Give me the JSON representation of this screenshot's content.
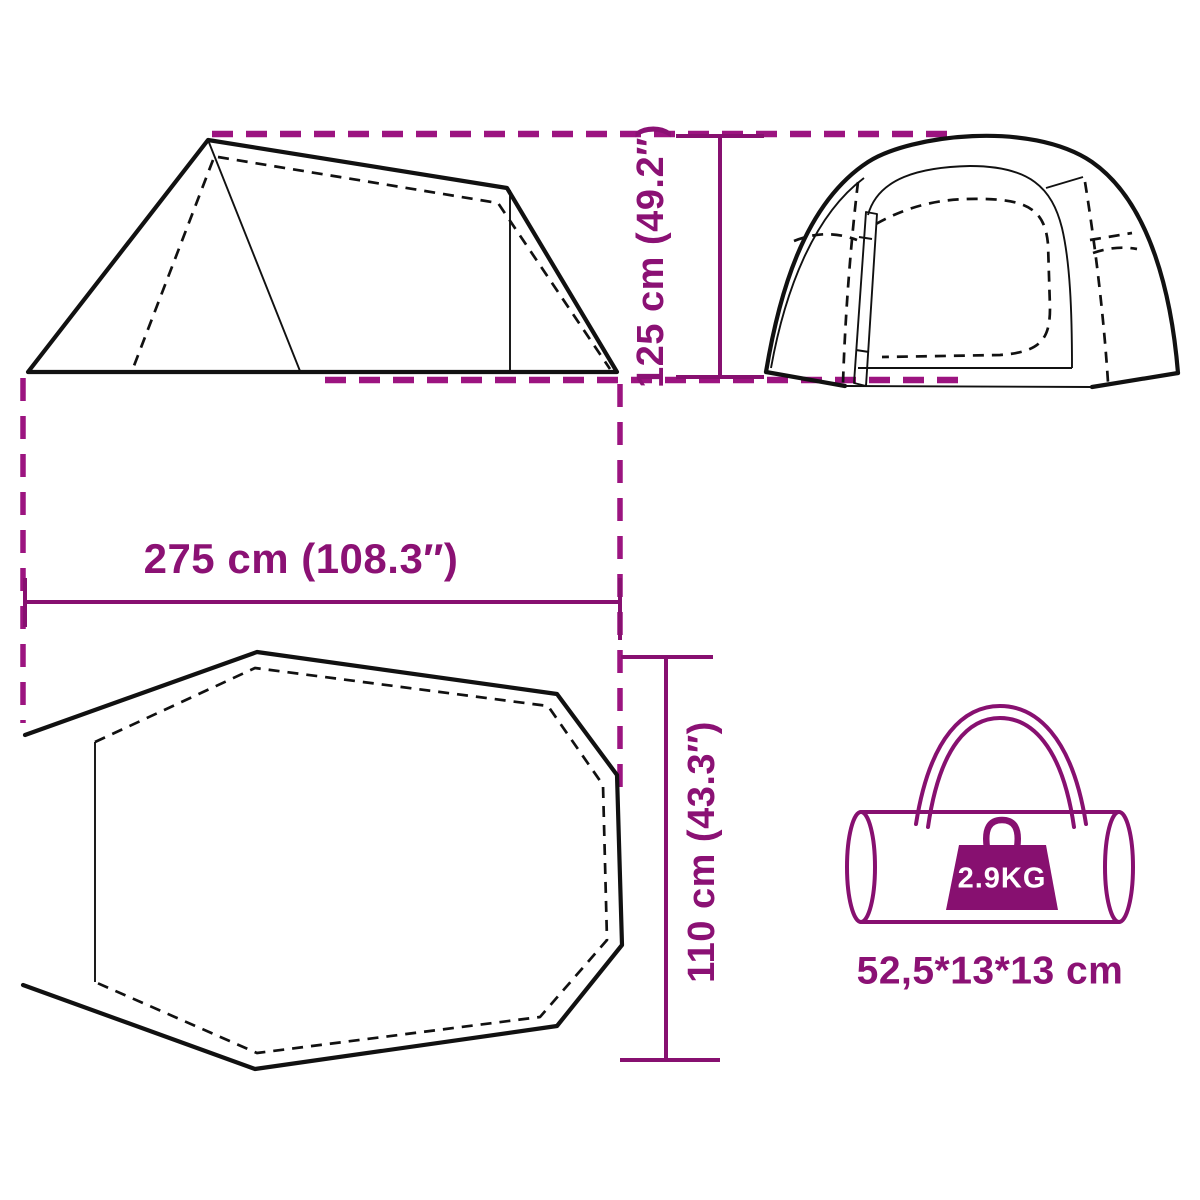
{
  "diagram": {
    "colors": {
      "accent_solid": "#871070",
      "accent_dashed": "#9c1480",
      "text": "#8b1174",
      "line_black": "#111111"
    },
    "dimensions": {
      "height": {
        "label": "125 cm (49.2″)"
      },
      "width": {
        "label": "275 cm (108.3″)"
      },
      "depth": {
        "label": "110 cm (43.3″)"
      }
    },
    "package": {
      "weight_label": "2.9KG",
      "size_label": "52,5*13*13 cm"
    }
  }
}
